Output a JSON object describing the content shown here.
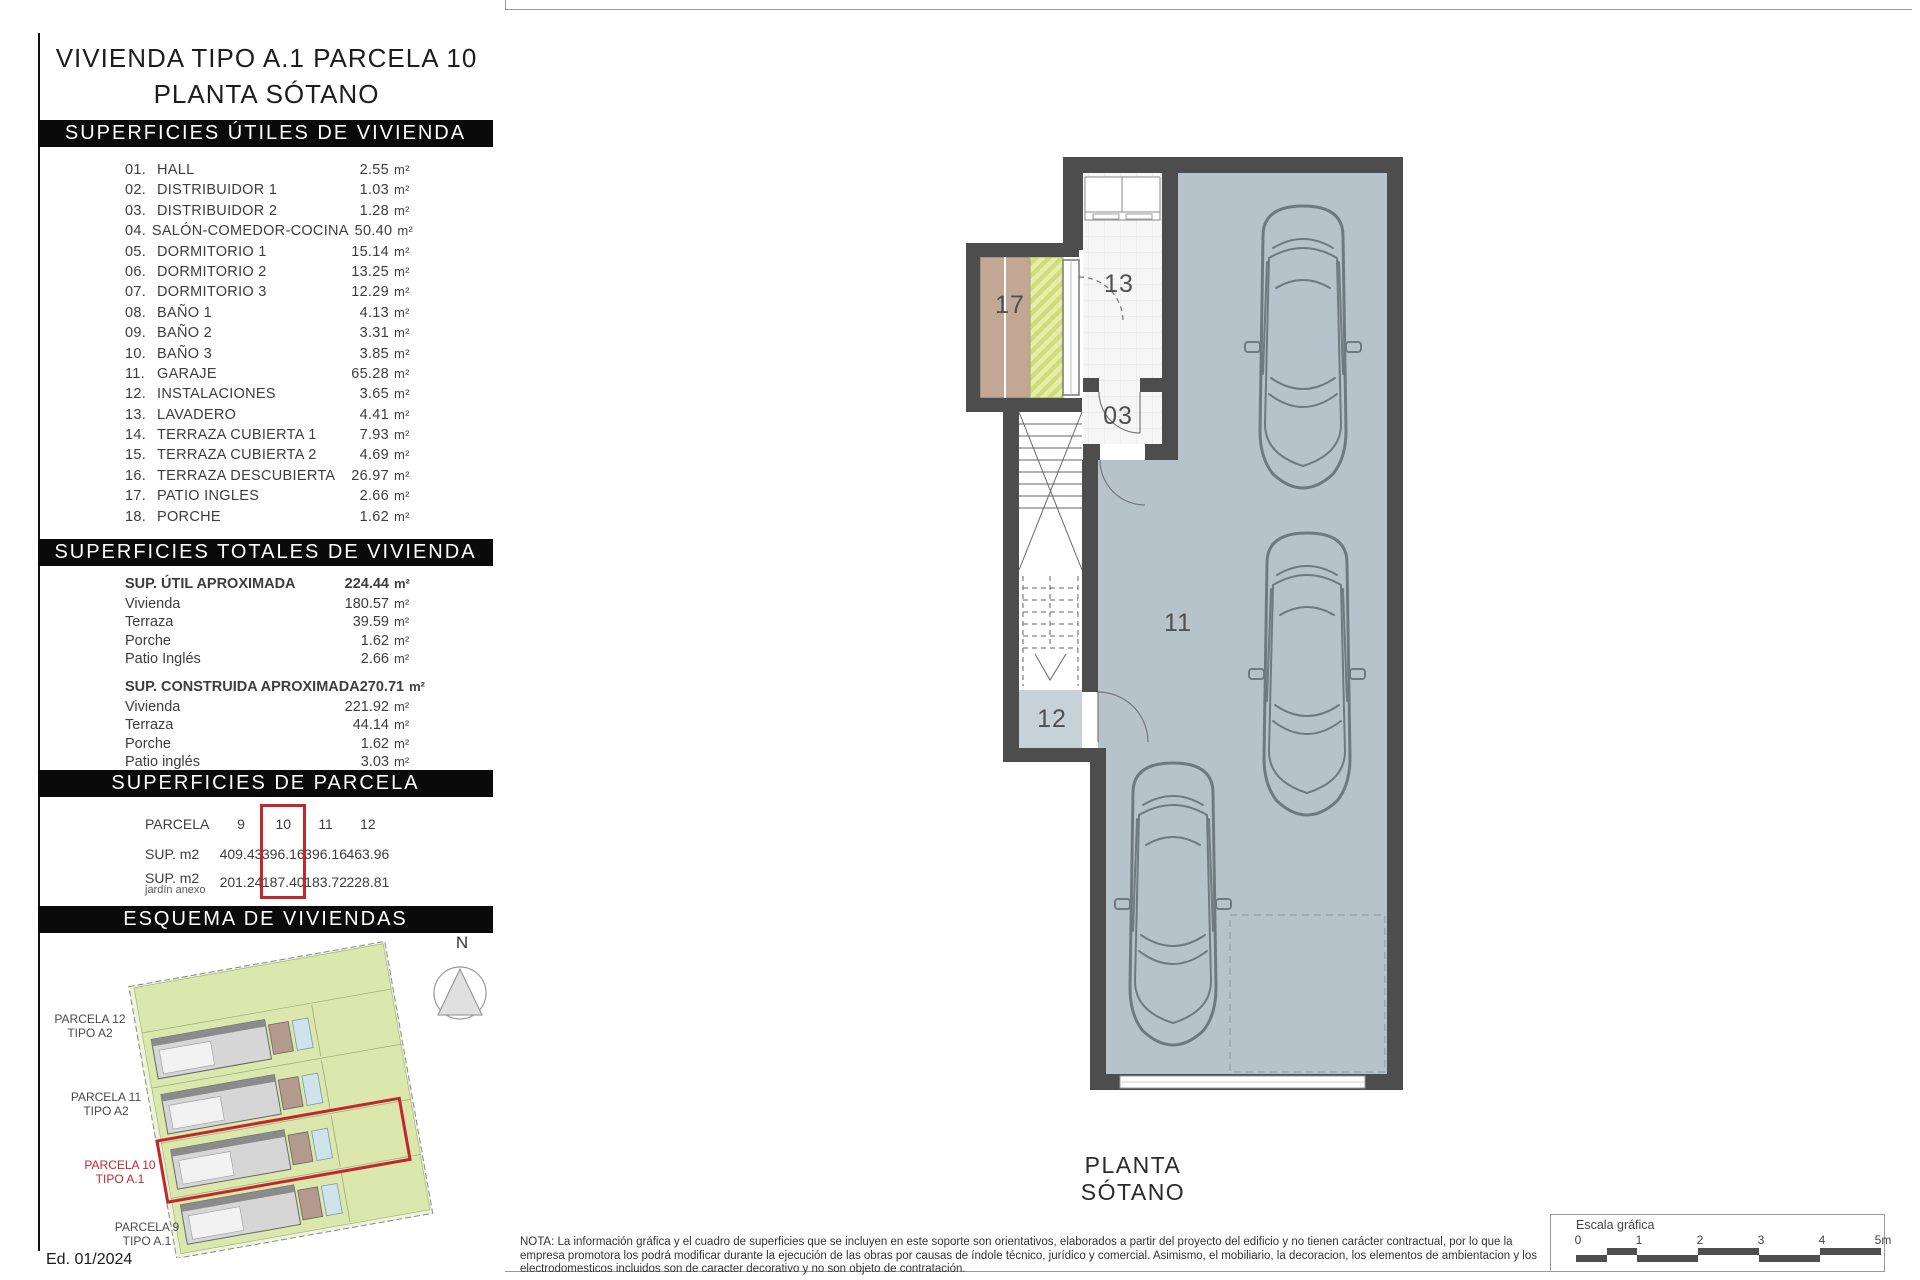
{
  "colors": {
    "accent_red": "#c1272d",
    "header_bar_bg": "#0a0a0a",
    "header_bar_text": "#ffffff",
    "wall": "#4d4d4d",
    "garage_floor": "#b7c3cb",
    "patio_tan": "#c2a795",
    "patio_hatch_green": "#d7e48c",
    "site_green": "#dbe7ad",
    "text": "#3d3d3d"
  },
  "title": {
    "line1": "VIVIENDA TIPO A.1 PARCELA 10",
    "line2": "PLANTA SÓTANO"
  },
  "unit": "m²",
  "sections": {
    "useful": {
      "header": "SUPERFICIES ÚTILES DE VIVIENDA",
      "rows": [
        {
          "num": "01.",
          "name": "HALL",
          "value": "2.55"
        },
        {
          "num": "02.",
          "name": "DISTRIBUIDOR 1",
          "value": "1.03"
        },
        {
          "num": "03.",
          "name": "DISTRIBUIDOR 2",
          "value": "1.28"
        },
        {
          "num": "04.",
          "name": "SALÓN-COMEDOR-COCINA",
          "value": "50.40"
        },
        {
          "num": "05.",
          "name": "DORMITORIO 1",
          "value": "15.14"
        },
        {
          "num": "06.",
          "name": "DORMITORIO 2",
          "value": "13.25"
        },
        {
          "num": "07.",
          "name": "DORMITORIO 3",
          "value": "12.29"
        },
        {
          "num": "08.",
          "name": "BAÑO 1",
          "value": "4.13"
        },
        {
          "num": "09.",
          "name": "BAÑO 2",
          "value": "3.31"
        },
        {
          "num": "10.",
          "name": "BAÑO 3",
          "value": "3.85"
        },
        {
          "num": "11.",
          "name": "GARAJE",
          "value": "65.28"
        },
        {
          "num": "12.",
          "name": "INSTALACIONES",
          "value": "3.65"
        },
        {
          "num": "13.",
          "name": "LAVADERO",
          "value": "4.41"
        },
        {
          "num": "14.",
          "name": "TERRAZA CUBIERTA 1",
          "value": "7.93"
        },
        {
          "num": "15.",
          "name": "TERRAZA CUBIERTA 2",
          "value": "4.69"
        },
        {
          "num": "16.",
          "name": "TERRAZA DESCUBIERTA",
          "value": "26.97"
        },
        {
          "num": "17.",
          "name": "PATIO INGLES",
          "value": "2.66"
        },
        {
          "num": "18.",
          "name": "PORCHE",
          "value": "1.62"
        }
      ]
    },
    "totals": {
      "header": "SUPERFICIES TOTALES DE VIVIENDA",
      "groups": [
        {
          "label": "SUP. ÚTIL APROXIMADA",
          "value": "224.44",
          "rows": [
            {
              "label": "Vivienda",
              "value": "180.57"
            },
            {
              "label": "Terraza",
              "value": "39.59"
            },
            {
              "label": "Porche",
              "value": "1.62"
            },
            {
              "label": "Patio Inglés",
              "value": "2.66"
            }
          ]
        },
        {
          "label": "SUP. CONSTRUIDA APROXIMADA",
          "value": "270.71",
          "rows": [
            {
              "label": "Vivienda",
              "value": "221.92"
            },
            {
              "label": "Terraza",
              "value": "44.14"
            },
            {
              "label": "Porche",
              "value": "1.62"
            },
            {
              "label": "Patio inglés",
              "value": "3.03"
            }
          ]
        }
      ]
    },
    "parcela": {
      "header": "SUPERFICIES DE PARCELA",
      "row1_label": "PARCELA",
      "row2_label": "SUP. m2",
      "row3_label": "SUP. m2",
      "row3_sublabel": "jardín anexo",
      "columns": [
        "9",
        "10",
        "11",
        "12"
      ],
      "sup_m2": [
        "409.43",
        "396.16",
        "396.16",
        "463.96"
      ],
      "jardin_anexo": [
        "201.24",
        "187.40",
        "183.72",
        "228.81"
      ],
      "highlighted_column": "10"
    },
    "esquema": {
      "header": "ESQUEMA DE VIVIENDAS",
      "compass": "N",
      "labels": [
        {
          "line1": "PARCELA 12",
          "line2": "TIPO A2",
          "highlight": false
        },
        {
          "line1": "PARCELA 11",
          "line2": "TIPO A2",
          "highlight": false
        },
        {
          "line1": "PARCELA 10",
          "line2": "TIPO A.1",
          "highlight": true
        },
        {
          "line1": "PARCELA 9",
          "line2": "TIPO A.1",
          "highlight": false
        }
      ]
    }
  },
  "plan": {
    "caption": "PLANTA SÓTANO",
    "room_labels": [
      "17",
      "13",
      "03",
      "11",
      "12"
    ]
  },
  "edition": "Ed. 01/2024",
  "footer": {
    "note_lines": [
      "NOTA: La información gráfica y el cuadro de superficies que se incluyen en este soporte son orientativos, elaborados a partir del proyecto del edificio y no tienen carácter contractual, por lo que la",
      "empresa promotora los podrá modificar durante la ejecución de las obras por causas de índole técnico, jurídico y comercial. Asimismo, el mobiliario, la decoracion, los elementos de ambientacion y los",
      "electrodomesticos incluidos son de caracter decorativo y no son objeto de contratación."
    ],
    "scale": {
      "label": "Escala gráfica",
      "ticks": [
        "0",
        "1",
        "2",
        "3",
        "4",
        "5m"
      ]
    }
  }
}
